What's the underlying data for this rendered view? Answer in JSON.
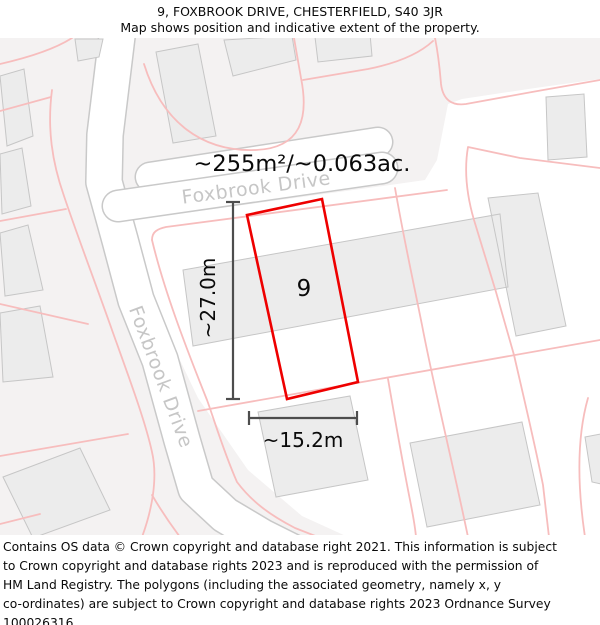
{
  "header": {
    "title": "9, FOXBROOK DRIVE, CHESTERFIELD, S40 3JR",
    "subtitle": "Map shows position and indicative extent of the property."
  },
  "map": {
    "area_label": "~255m²/~0.063ac.",
    "plot_number": "9",
    "height_label": "~27.0m",
    "width_label": "~15.2m",
    "street_label_top": "Foxbrook Drive",
    "street_label_left": "Foxbrook Drive",
    "colors": {
      "property_outline": "#ee0000",
      "parcel_line": "#f7bdbd",
      "building_fill": "#ececec",
      "building_stroke": "#c6c6c6",
      "road_fill": "#ffffff",
      "road_edge": "#c9c9c9",
      "background": "#f4f2f2",
      "street_label": "#c6c6c6",
      "dimension_line": "#4d4d4d"
    }
  },
  "footer": {
    "lines": [
      "Contains OS data © Crown copyright and database right 2021. This information is subject",
      "to Crown copyright and database rights 2023 and is reproduced with the permission of",
      "HM Land Registry. The polygons (including the associated geometry, namely x, y",
      "co-ordinates) are subject to Crown copyright and database rights 2023 Ordnance Survey",
      "100026316."
    ]
  }
}
